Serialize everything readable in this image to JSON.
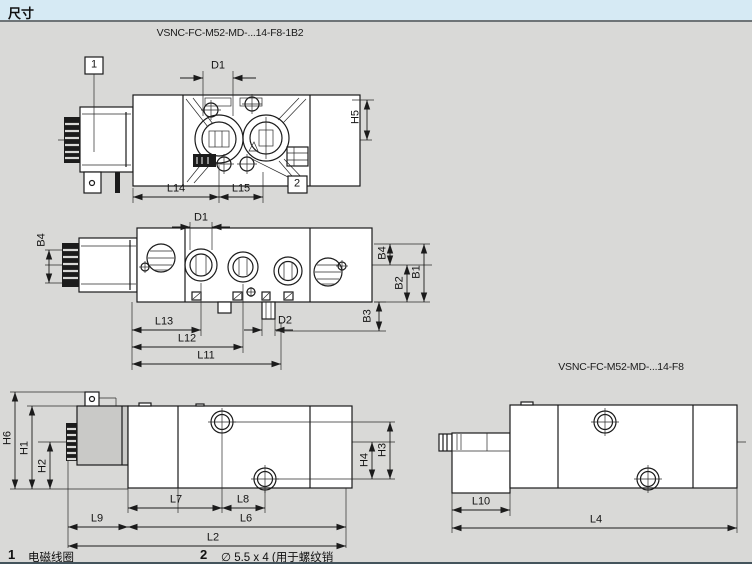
{
  "colors": {
    "header_bg": "#d6eaf4",
    "canvas_bg": "#d9d9d7",
    "line": "#1b1b1b"
  },
  "header": {
    "title": "尺寸"
  },
  "drawings": {
    "top_view": {
      "title": "VSNC-FC-M52-MD-...14-F8-1B2",
      "callout_1": "1",
      "callout_2": "2",
      "dims": {
        "d1": "D1",
        "h5": "H5",
        "l14": "L14",
        "l15": "L15"
      }
    },
    "front_view": {
      "dims": {
        "d1": "D1",
        "d2": "D2",
        "l11": "L11",
        "l12": "L12",
        "l13": "L13",
        "b1": "B1",
        "b2": "B2",
        "b3": "B3",
        "b4_left": "B4",
        "b4_right": "B4"
      }
    },
    "side_view": {
      "dims": {
        "h1": "H1",
        "h2": "H2",
        "h3": "H3",
        "h4": "H4",
        "h6": "H6",
        "l2": "L2",
        "l6": "L6",
        "l7": "L7",
        "l8": "L8",
        "l9": "L9"
      }
    },
    "side_view_f8": {
      "title": "VSNC-FC-M52-MD-...14-F8",
      "dims": {
        "l4": "L4",
        "l10": "L10"
      }
    }
  },
  "legend": {
    "items": [
      {
        "num": "1",
        "text": "电磁线圈"
      },
      {
        "num": "2",
        "text": "∅ 5.5 x 4 (用于螺纹销"
      }
    ]
  }
}
